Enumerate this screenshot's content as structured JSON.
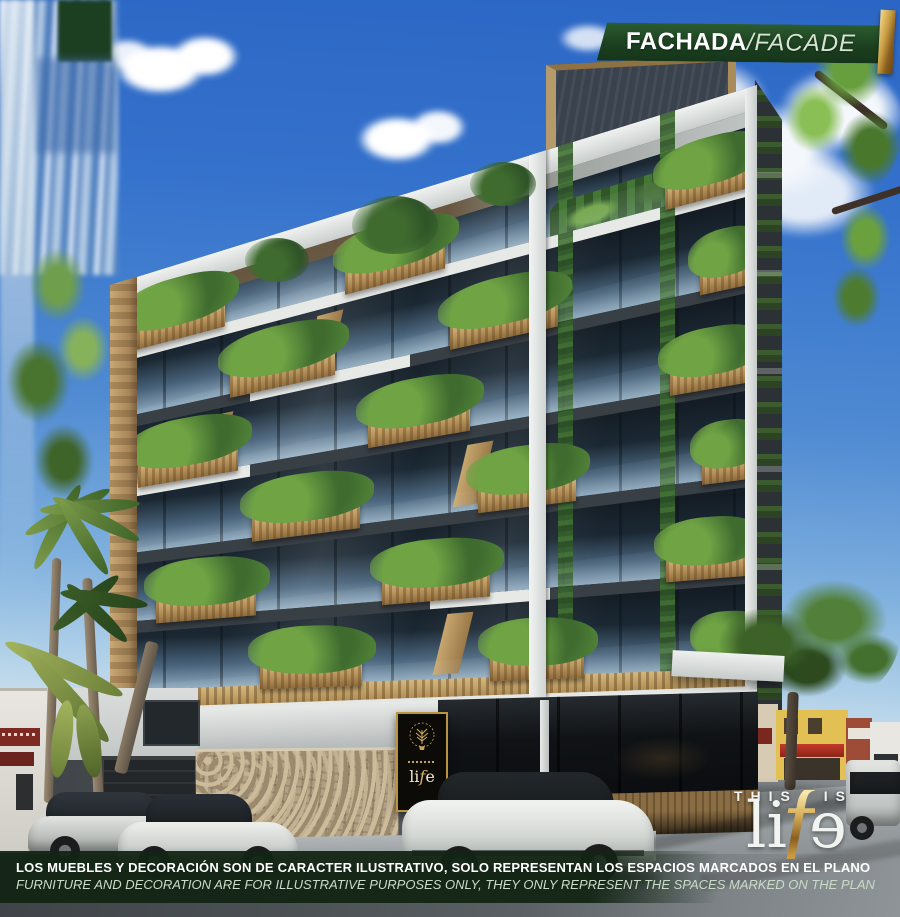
{
  "banner": {
    "title_primary": "FACHADA",
    "separator": "/",
    "title_secondary": "FACADE"
  },
  "disclaimer": {
    "line_es": "LOS MUEBLES Y DECORACIÓN SON DE CARACTER ILUSTRATIVO, SOLO REPRESENTAN LOS ESPACIOS MARCADOS EN EL PLANO",
    "line_en": "FURNITURE AND DECORATION ARE FOR ILLUSTRATIVE PURPOSES ONLY, THEY ONLY REPRESENT THE SPACES MARKED ON THE PLAN"
  },
  "brand": {
    "tagline": "THIS IS",
    "name_li": "li",
    "name_f": "f",
    "name_e": "e"
  },
  "colors": {
    "banner_green": "#1c4020",
    "gold": "#caa045",
    "sky_blue": "#4f8ad2",
    "wood": "#b8945c",
    "foliage": "#3f6b2f"
  }
}
